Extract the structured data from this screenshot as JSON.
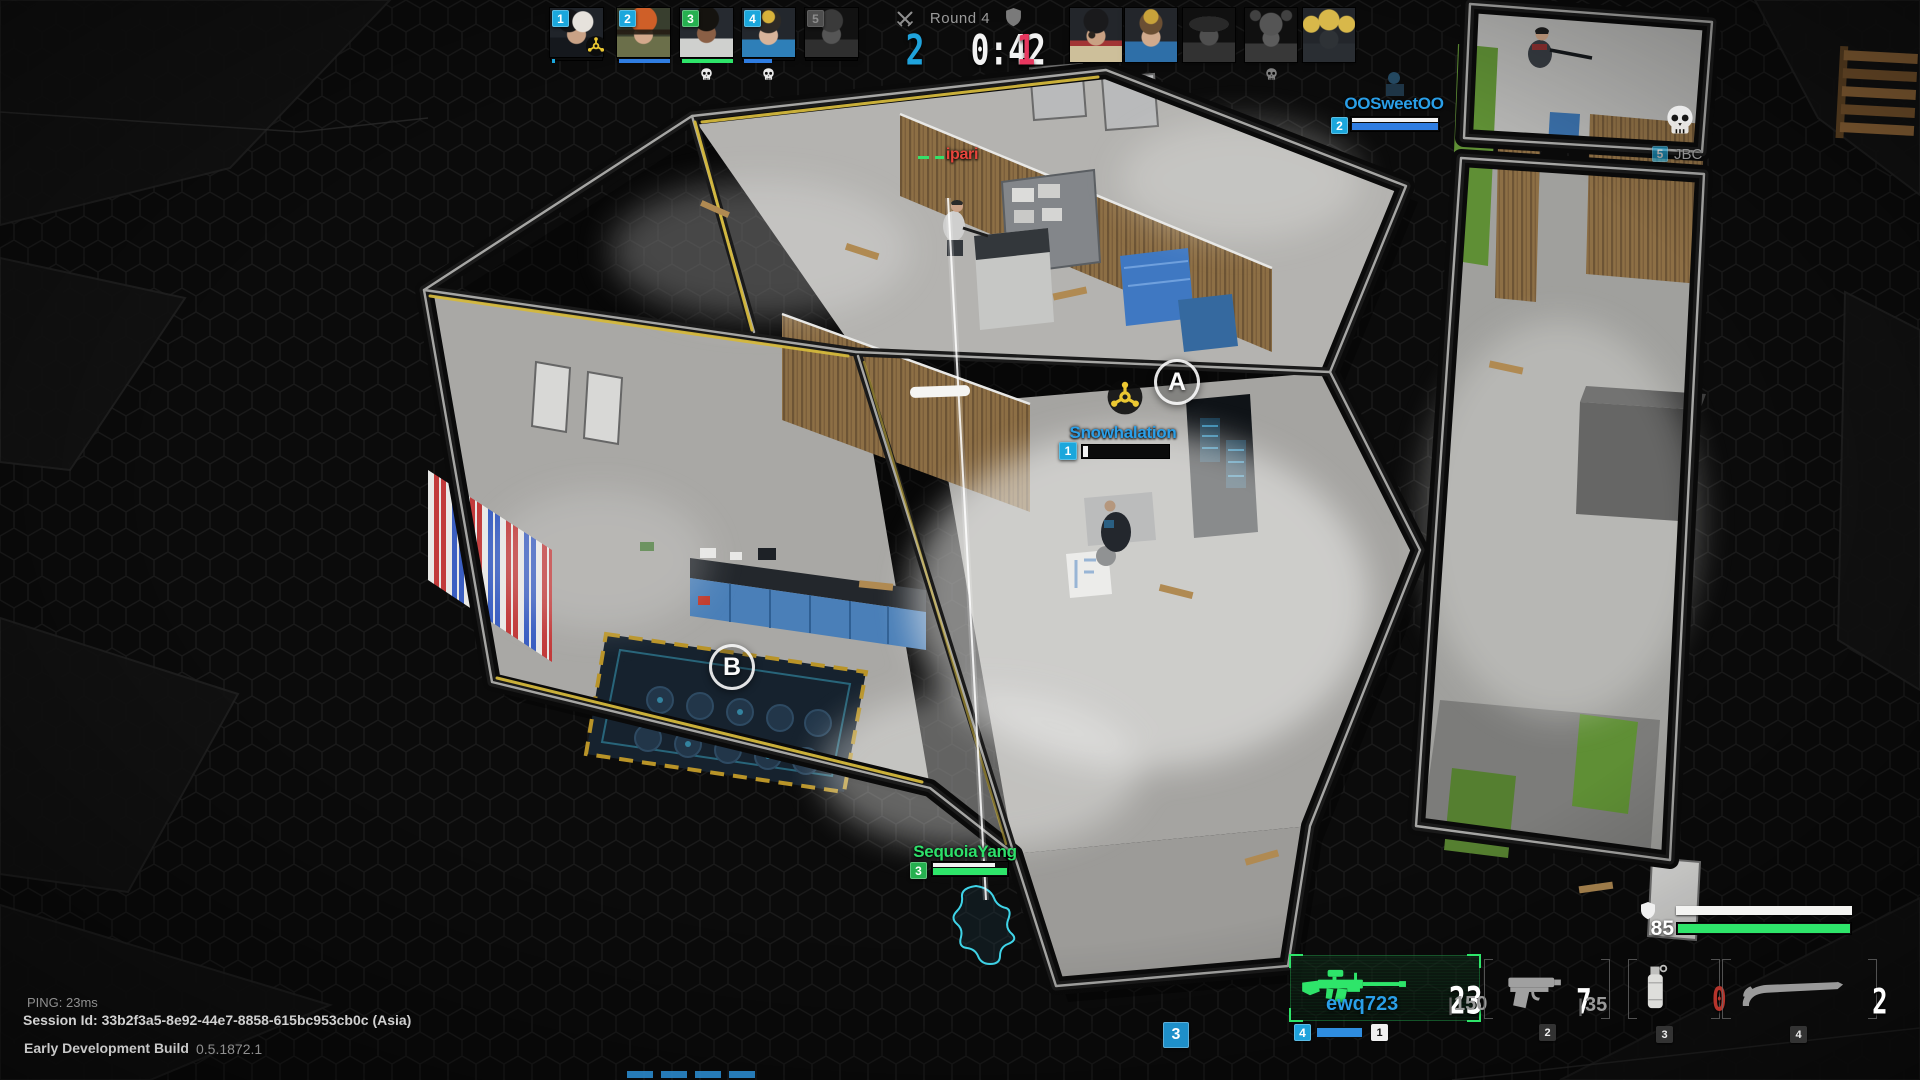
{
  "scoreboard": {
    "round": "Round 4",
    "ally_score": "2",
    "timer": "0:42",
    "enemy_score": "1",
    "ally_color": "#1fa3dc",
    "enemy_color": "#e8375f"
  },
  "ally_team": {
    "players": [
      {
        "n": "1",
        "portrait": "pa1",
        "badge": "#1ba7dc",
        "armor": "0%",
        "hp": "6%",
        "hp_color": "#1ba7dc",
        "dead": false,
        "skull": false,
        "bomb": true
      },
      {
        "n": "2",
        "portrait": "pa2",
        "badge": "#1ba7dc",
        "armor": "100%",
        "hp": "100%",
        "hp_color": "#2f7de1",
        "dead": false,
        "skull": false,
        "bomb": false
      },
      {
        "n": "3",
        "portrait": "pa3",
        "badge": "#26b050",
        "armor": "100%",
        "hp": "100%",
        "hp_color": "#2ee56a",
        "dead": false,
        "skull": true,
        "bomb": false
      },
      {
        "n": "4",
        "portrait": "pa4",
        "badge": "#1ba7dc",
        "armor": "0%",
        "hp": "55%",
        "hp_color": "#2f7de1",
        "dead": false,
        "skull": true,
        "bomb": false
      },
      {
        "n": "5",
        "portrait": "pa5",
        "badge": "#1ba7dc",
        "armor": "0%",
        "hp": "0%",
        "hp_color": "#2f7de1",
        "dead": true,
        "skull": false,
        "bomb": false
      }
    ]
  },
  "enemy_team": {
    "players": [
      {
        "portrait": "pe1",
        "dead": false,
        "skull": false
      },
      {
        "portrait": "pe2",
        "dead": false,
        "skull": false
      },
      {
        "portrait": "pe3",
        "dead": true,
        "skull": false
      },
      {
        "portrait": "pe4",
        "dead": true,
        "skull": true
      },
      {
        "portrait": "pe5",
        "dead": false,
        "skull": false
      }
    ]
  },
  "tags": {
    "sweet": {
      "name": "OOSweetOO",
      "n": "2",
      "name_color": "#2a9fe8",
      "badge_color": "#1ba7dc",
      "armor": "100%",
      "hp": "100%",
      "hp_color": "#2f7de1"
    },
    "snow": {
      "name": "Snowhalation",
      "n": "1",
      "name_color": "#2a9fe8",
      "badge_color": "#1ba7dc",
      "hp": "6%",
      "hp_color": "#f2f2f2"
    },
    "seq": {
      "name": "SequoiaYang",
      "n": "3",
      "name_color": "#2ee06a",
      "badge_color": "#26b050",
      "armor": "84%",
      "hp": "100%",
      "hp_color": "#2ee56a"
    },
    "ipari": {
      "name": "ipari",
      "name_color": "#e8453c"
    },
    "dead_enemy": {
      "n": "5",
      "name": "JBC",
      "badge_color": "#1ba7dc"
    }
  },
  "sites": {
    "a": "A",
    "b": "B"
  },
  "loadout": {
    "primary": {
      "owner": "ewq723",
      "ammo": "23",
      "reserve": "150",
      "key": "1",
      "mate_badge": "4",
      "accent": "#2ee56a",
      "owner_color": "#2a9fe8"
    },
    "secondary": {
      "ammo": "7",
      "reserve": "35",
      "key": "2"
    },
    "grenade": {
      "count": "0",
      "key": "3",
      "count_color": "#b5342c"
    },
    "melee": {
      "count": "2",
      "key": "4"
    }
  },
  "vitals": {
    "health": "85",
    "armor_w": "82%",
    "hp_w": "100%",
    "hp_color": "#2ee56a"
  },
  "system": {
    "ping": "PING:  23ms",
    "session": "Session Id: 33b2f3a5-8e92-44e7-8858-615bc953cb0c (Asia)",
    "build": "Early Development Build",
    "version": "0.5.1872.1"
  },
  "misc": {
    "bottom_badge": "3"
  }
}
